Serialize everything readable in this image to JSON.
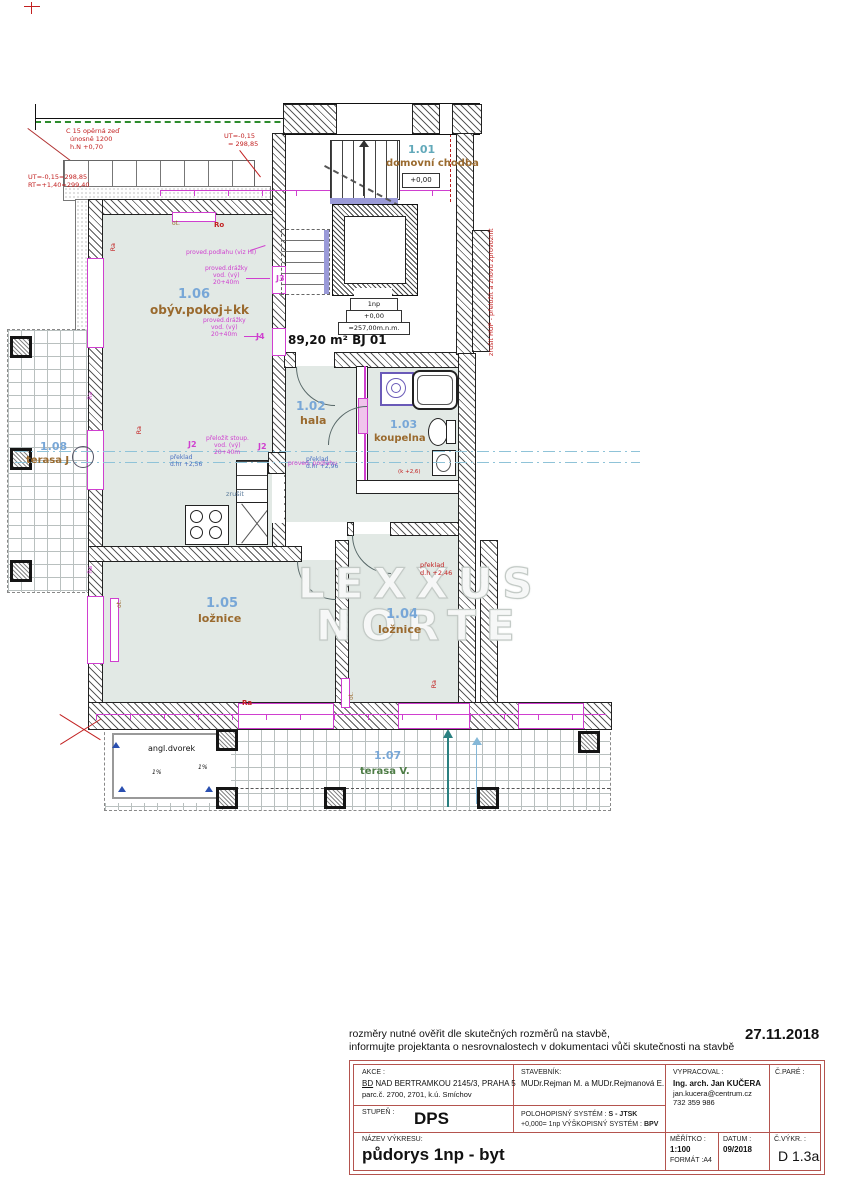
{
  "colors": {
    "room_fill": "#e2e9e5",
    "magenta": "#cf3fcf",
    "annotation_red": "#c22020",
    "room_number_blue": "#78a7d7",
    "room_number_teal": "#62a9ba",
    "room_name_brown": "#9a6a2e",
    "terrace_name_green": "#4e7d46",
    "title_border_red": "#b4534e",
    "landing_blue": "#9a9ad8",
    "cut_line_cyan": "#8fc3d8",
    "arrow_teal": "#2a8080"
  },
  "top_notes": {
    "line1": "rozměry nutné ověřit dle skutečných rozměrů na stavbě,",
    "line2": "informujte projektanta o nesrovnalostech v dokumentaci vůči skutečnosti na stavbě",
    "date": "27.11.2018"
  },
  "rooms": [
    {
      "number": "1.01",
      "name": "domovní chodba",
      "level": "+0,00"
    },
    {
      "number": "1.02",
      "name": "hala"
    },
    {
      "number": "1.03",
      "name": "koupelna"
    },
    {
      "number": "1.04",
      "name": "ložnice"
    },
    {
      "number": "1.05",
      "name": "ložnice"
    },
    {
      "number": "1.06",
      "name": "obýv.pokoj+kk"
    },
    {
      "number": "1.07",
      "name": "terasa V."
    },
    {
      "number": "1.08",
      "name": "terasa J"
    }
  ],
  "plan": {
    "area_label": "89,20 m² BJ 01",
    "watermark_line1": "LEXXUS",
    "watermark_line2": "NORTE",
    "elevator_box": {
      "line1": "1np",
      "line2": "+0,00",
      "line3": "≈257,00m.n.m."
    },
    "courtyard_label": "angl.dvorek",
    "slope_label": "1%",
    "labels": {
      "ra": "Ra",
      "ro": "Ro",
      "ot": "ot.",
      "j2": "J2",
      "j3": "J3",
      "j4": "J4"
    },
    "annotations": {
      "retaining_line1": "C 15 opěrná zeď",
      "retaining_line2": "únosně 1200",
      "retaining_line3": "h.N +0,70",
      "ut_left_line1": "UT=-0,15=298,85",
      "ut_left_line2": "RT=+1,40=299,40",
      "ut_mid_line1": "UT=-0,15",
      "ut_mid_line2": "= 298,85",
      "lintel_256_line1": "překlad",
      "lintel_256_line2": "d.hr +2,56",
      "lintel_296_line1": "překlad",
      "lintel_296_line2": "d.hr +2,96",
      "lintel_246_line1": "překlad",
      "lintel_246_line2": "d.h +2,46",
      "cancel_note": "zrušit",
      "bath_level": "(k +2,6)",
      "gas_note": "zrušit HUP - přeložit a znovu zprovoznit",
      "floor_note": "proved.podlahu (viz HI)",
      "chase_line1": "proved.drážky",
      "chase_line2": "vod. (vý)",
      "chase_line3": "20+40m",
      "riser_line1": "přeložit stoup.",
      "riser_line2": "vod. (vý)",
      "floor_note2": "proved. podlahu"
    }
  },
  "title_block": {
    "akce_label": "AKCE :",
    "akce_line1_u": "BD",
    "akce_line1": " NAD BERTRAMKOU 2145/3, PRAHA 5",
    "akce_line2": "parc.č. 2700, 2701, k.ú. Smíchov",
    "stavebnik_label": "STAVEBNÍK:",
    "stavebnik_value": "MUDr.Rejman M. a MUDr.Rejmanová E.",
    "vypracoval_label": "VYPRACOVAL :",
    "vypracoval_name": "Ing. arch. Jan KUČERA",
    "vypracoval_email": "jan.kucera@centrum.cz",
    "vypracoval_phone": "732 359 986",
    "cpare_label": "Č.PARÉ :",
    "stupen_label": "STUPEŇ :",
    "stupen_value": "DPS",
    "system_label": "POLOHOPISNÝ SYSTÉM :",
    "system_value": "S - JTSK",
    "system2_label": "+0,000= 1np VÝŠKOPISNÝ SYSTÉM :",
    "system2_value": "BPV",
    "nazev_label": "NÁZEV VÝKRESU:",
    "nazev_value": "půdorys 1np - byt",
    "meritko_label": "MĚŘÍTKO :",
    "meritko_value": "1:100",
    "format_label": "FORMÁT :A4",
    "datum_label": "DATUM :",
    "datum_value": "09/2018",
    "cvykr_label": "Č.VÝKR. :",
    "cvykr_value": "D 1.3a"
  }
}
